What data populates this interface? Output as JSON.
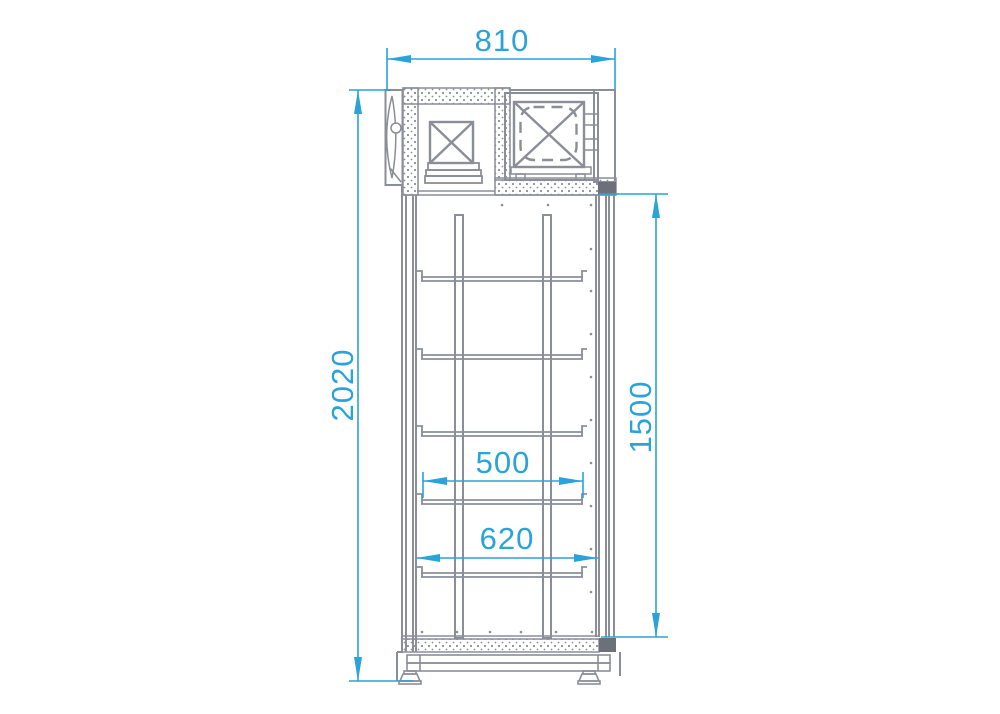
{
  "drawing": {
    "type": "technical-line-drawing",
    "view": "cabinet-side-view-with-dimensions"
  },
  "dimensions": {
    "top_width": "810",
    "overall_height": "2020",
    "door_height": "1500",
    "shelf_span": "500",
    "interior_width": "620"
  },
  "colors": {
    "dimension_accent": "#2aa2da",
    "drawing_line": "#8a8e99",
    "dark_fill": "#6b7079",
    "background": "#ffffff"
  }
}
